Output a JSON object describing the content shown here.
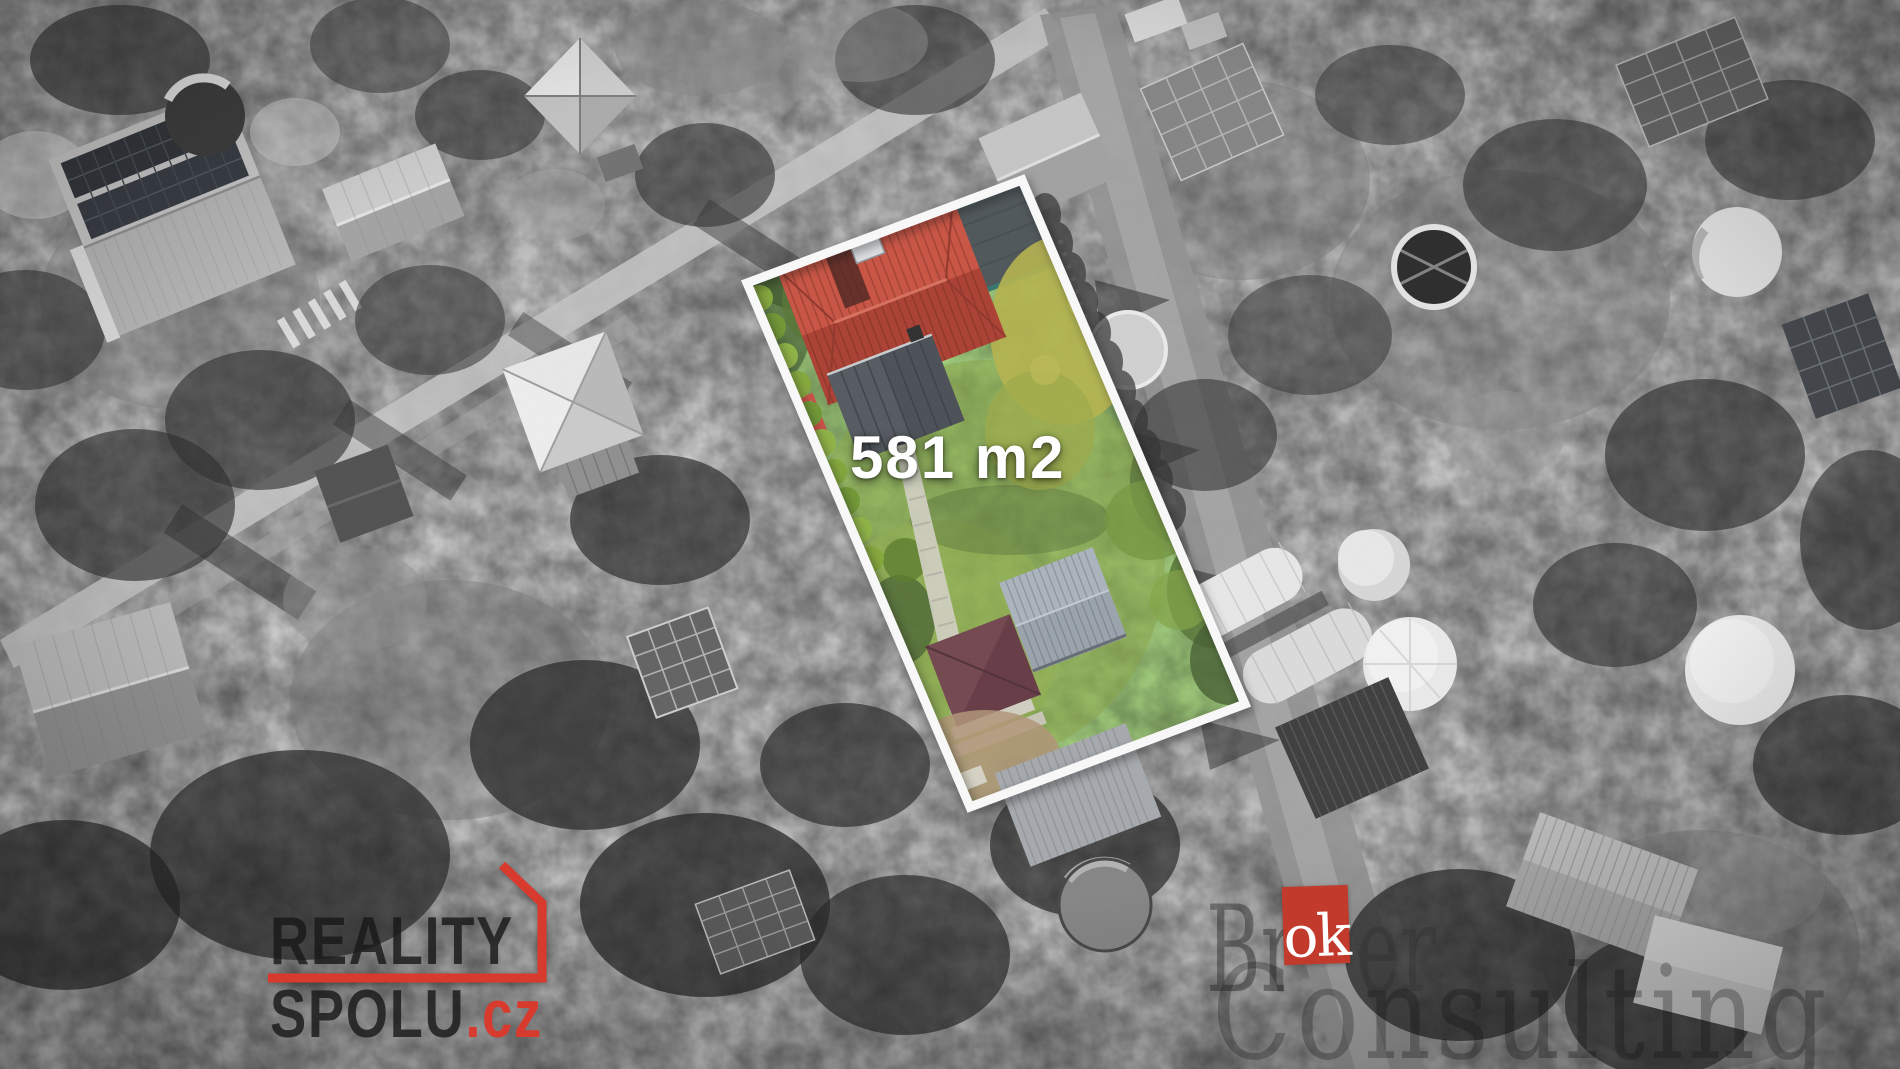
{
  "parcel": {
    "area_label": "581 m2",
    "border_color": "#ffffff",
    "roof_color": "#c23b2c",
    "garden_color": "#6a8c38"
  },
  "agency_logo": {
    "line1": "REALITY",
    "line2": "SPOLU",
    "tld": ".cz",
    "accent_color": "#d93a2e",
    "text_color": "#1c1c1c"
  },
  "watermark": {
    "prefix": "Br",
    "highlight": "ok",
    "suffix": "er",
    "line2": "Consulting",
    "box_color": "#c23a2b",
    "box_text_color": "#ffffff"
  }
}
